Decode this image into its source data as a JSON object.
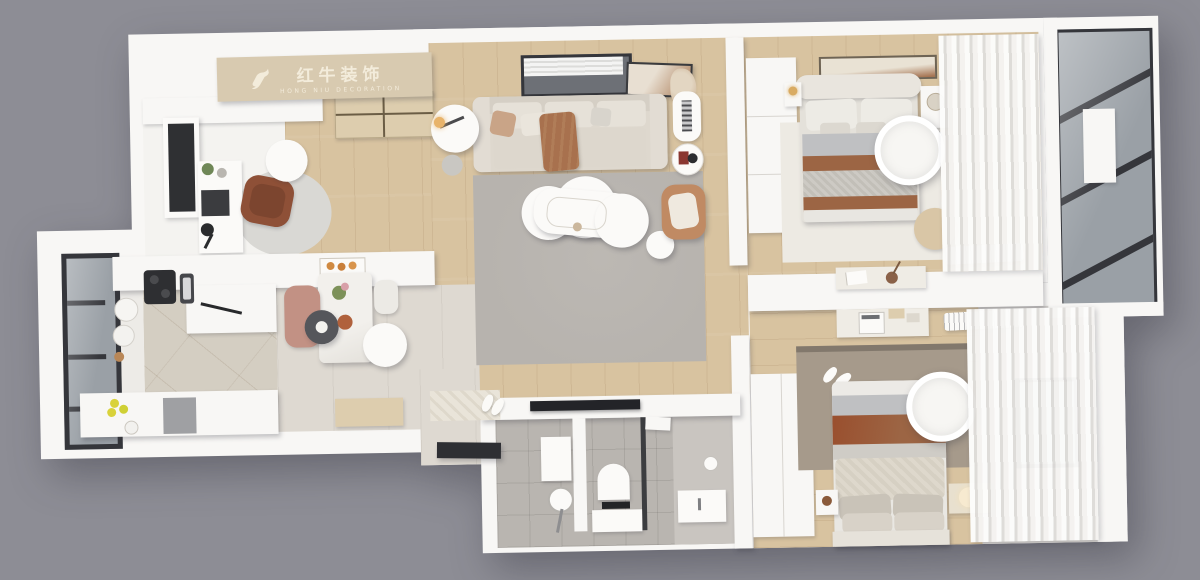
{
  "logo": {
    "brand_cn": "红牛装饰",
    "brand_en": "HONG NIU DECORATION"
  },
  "colors": {
    "background": "#8d8d95",
    "wall": "#f8f7f5",
    "wood": "#d8c3a0",
    "wood-light": "#ddcdae",
    "stone": "#ded9d1",
    "kitchen-tile": "#d4cec2",
    "bath-tile": "#b9b5b0",
    "bath-tile-light": "#c9c5c0",
    "rug": "#b7b3ae",
    "rug-taupe": "#a69a8b",
    "rug-study": "#d9d8d4",
    "sofa": "#ded8ce",
    "cushion": "#e6e1d8",
    "cream": "#edeae3",
    "bed-gray": "#bfc0c2",
    "brown": "#9c6544",
    "brown-dark": "#8e5037",
    "tan": "#c08a63",
    "glass": "#9aa0a6",
    "frame-dark": "#35363b",
    "logo-wood": "#d8cab0",
    "logo-text": "#f6efdf",
    "furn-white": "#fbfaf8"
  }
}
